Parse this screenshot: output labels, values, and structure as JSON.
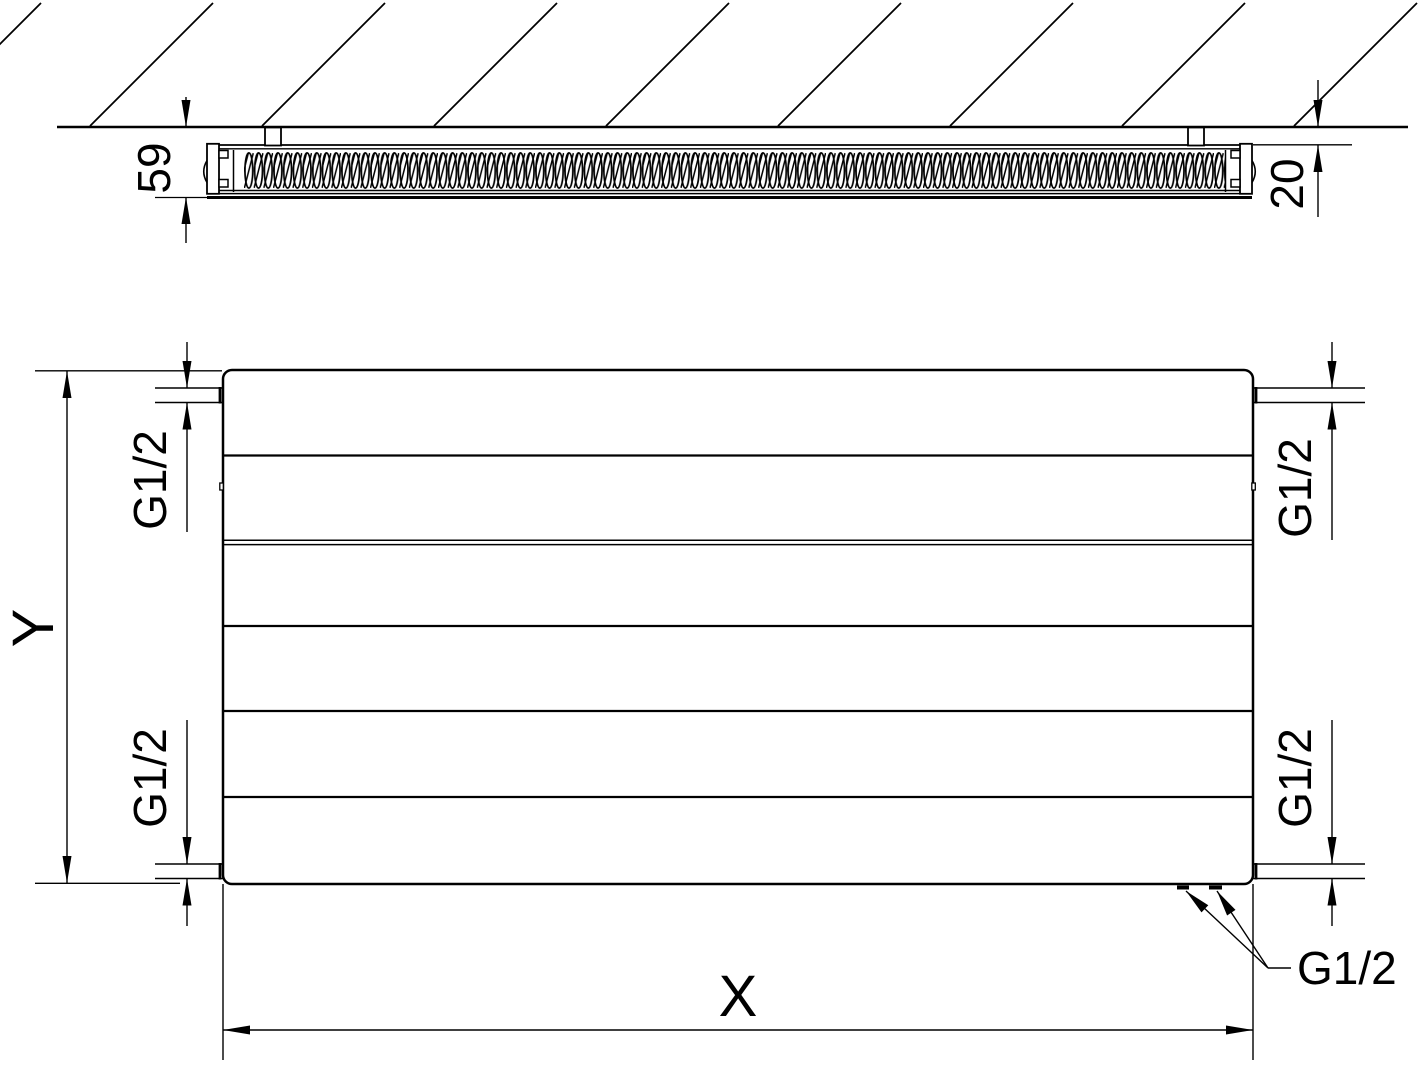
{
  "page": {
    "background": "#ffffff",
    "line_color": "#000000"
  },
  "top_view": {
    "depth_dimension": "59",
    "wall_clearance_dimension": "20"
  },
  "front_view": {
    "width_dimension": "X",
    "height_dimension": "Y",
    "thread_top_left": "G1/2",
    "thread_top_right": "G1/2",
    "thread_bottom_left": "G1/2",
    "thread_bottom_right": "G1/2",
    "thread_bottom_connections": "G1/2"
  }
}
